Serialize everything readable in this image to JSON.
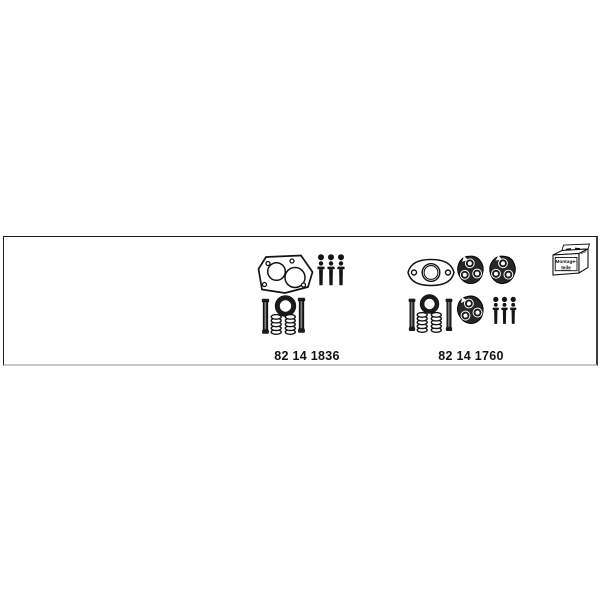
{
  "page": {
    "background": "#ffffff"
  },
  "panel": {
    "border_color": "#1c1c1c",
    "right_border_color": "#3c3c3c",
    "shadow_color": "#c8c8c8",
    "ink_color": "#141414"
  },
  "kits": [
    {
      "part_number": "82 14 1836",
      "part_icons": [
        "two-port-flange-gasket-icon",
        "nut-bolt-set-icon",
        "seal-ring-icon",
        "stud-bolt-icon",
        "stud-bolt-icon",
        "coil-spring-icon",
        "coil-spring-icon"
      ]
    },
    {
      "part_number": "82 14 1760",
      "part_icons": [
        "oval-flange-gasket-icon",
        "three-hole-flange-icon",
        "three-hole-flange-icon",
        "three-hole-flange-icon",
        "seal-ring-icon",
        "stud-bolt-icon",
        "stud-bolt-icon",
        "coil-spring-icon",
        "coil-spring-icon",
        "nut-bolt-set-icon"
      ]
    }
  ],
  "mounting_parts_box": {
    "label_line1": "Montage-",
    "label_line2": "teile"
  }
}
